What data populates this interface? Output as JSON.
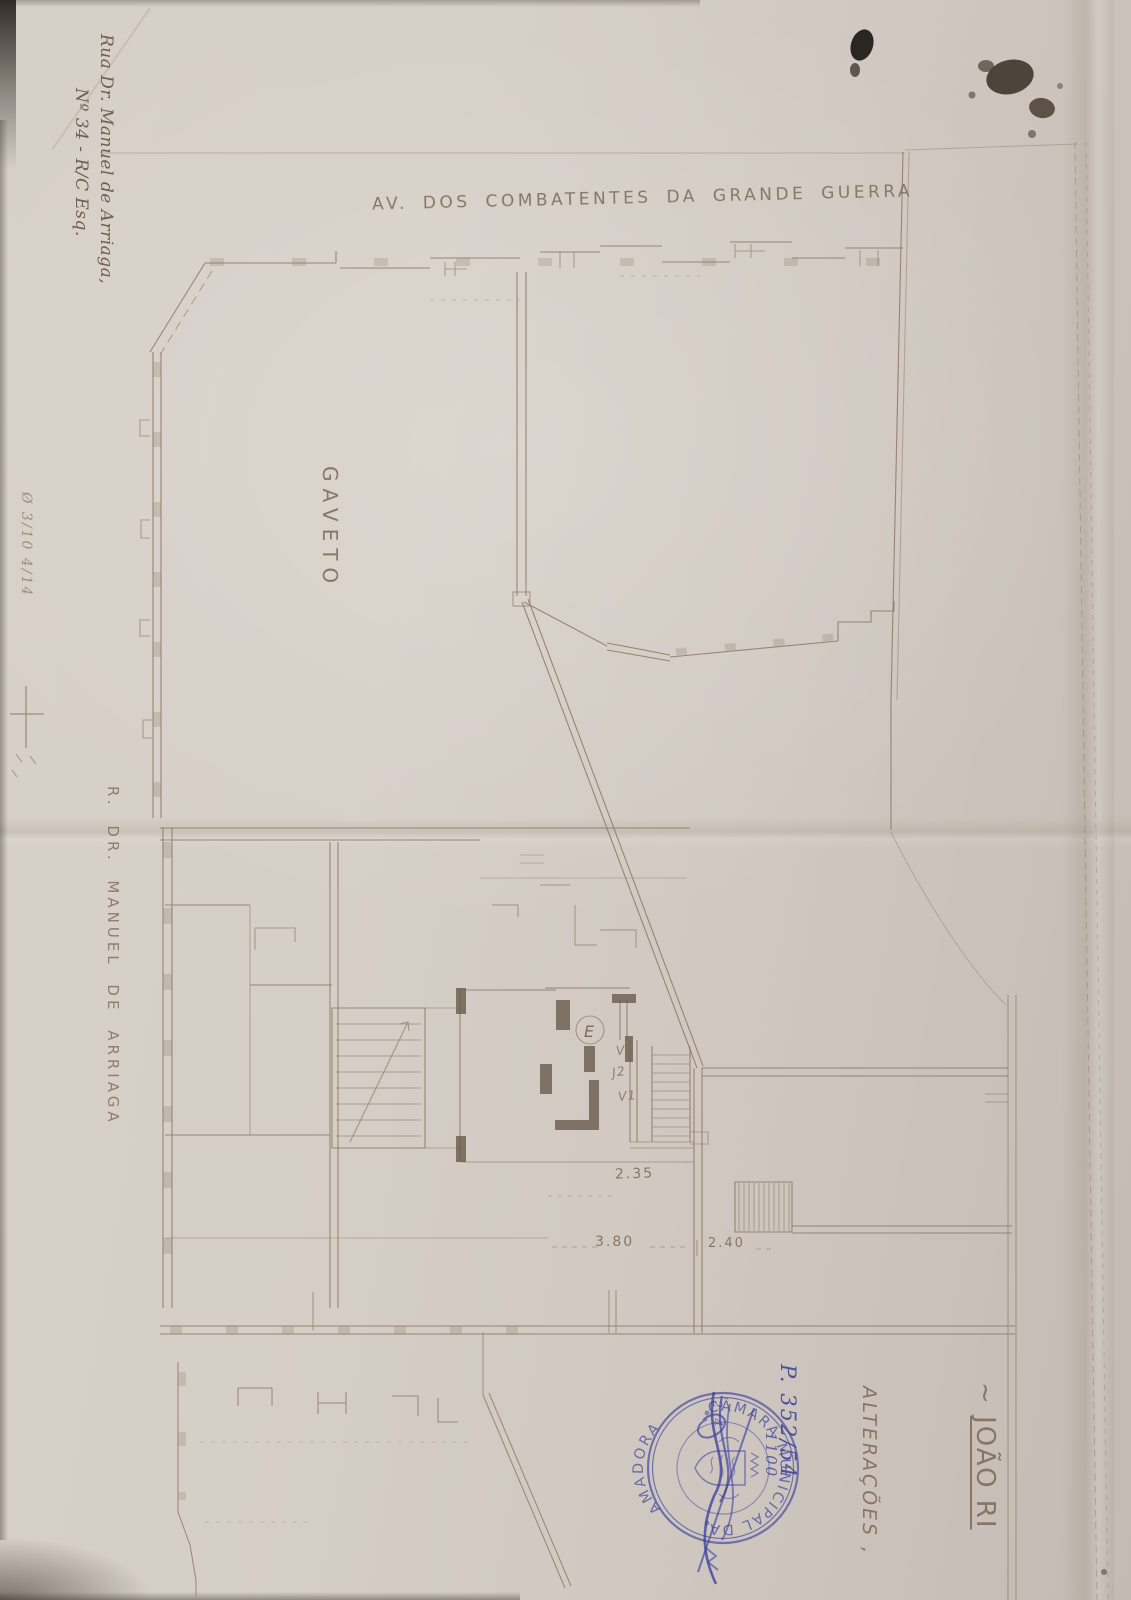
{
  "labels": {
    "street_top": "AV. DOS COMBATENTES DA GRANDE GUERRA",
    "corner": "GAVETO",
    "street_left": "R. DR. MANUEL DE ARRIAGA",
    "address_line1": "Rua Dr. Manuel de Arriaga,",
    "address_line2": "Nº 34 - R/C Esq.",
    "margin_note": "Ø 3/10 4/14",
    "title_prefix": "~ ",
    "title_text": "JOÃO RI",
    "subject": "ALTERAÇÕES ,"
  },
  "dimensions": {
    "d1": "2.35",
    "d2": "3.80",
    "d3": "2.40"
  },
  "plan_marks": {
    "circled_room": "E",
    "opening1": "V1",
    "opening2": "J2",
    "opening3": "V1"
  },
  "stamp": {
    "arc_top": "CÂMARA MUNICIPAL DA",
    "arc_bottom": "AMADORA",
    "process_number": "P. 352/54",
    "note_a": "2 4",
    "note_b": "1100",
    "ink_color": "#41479e"
  }
}
